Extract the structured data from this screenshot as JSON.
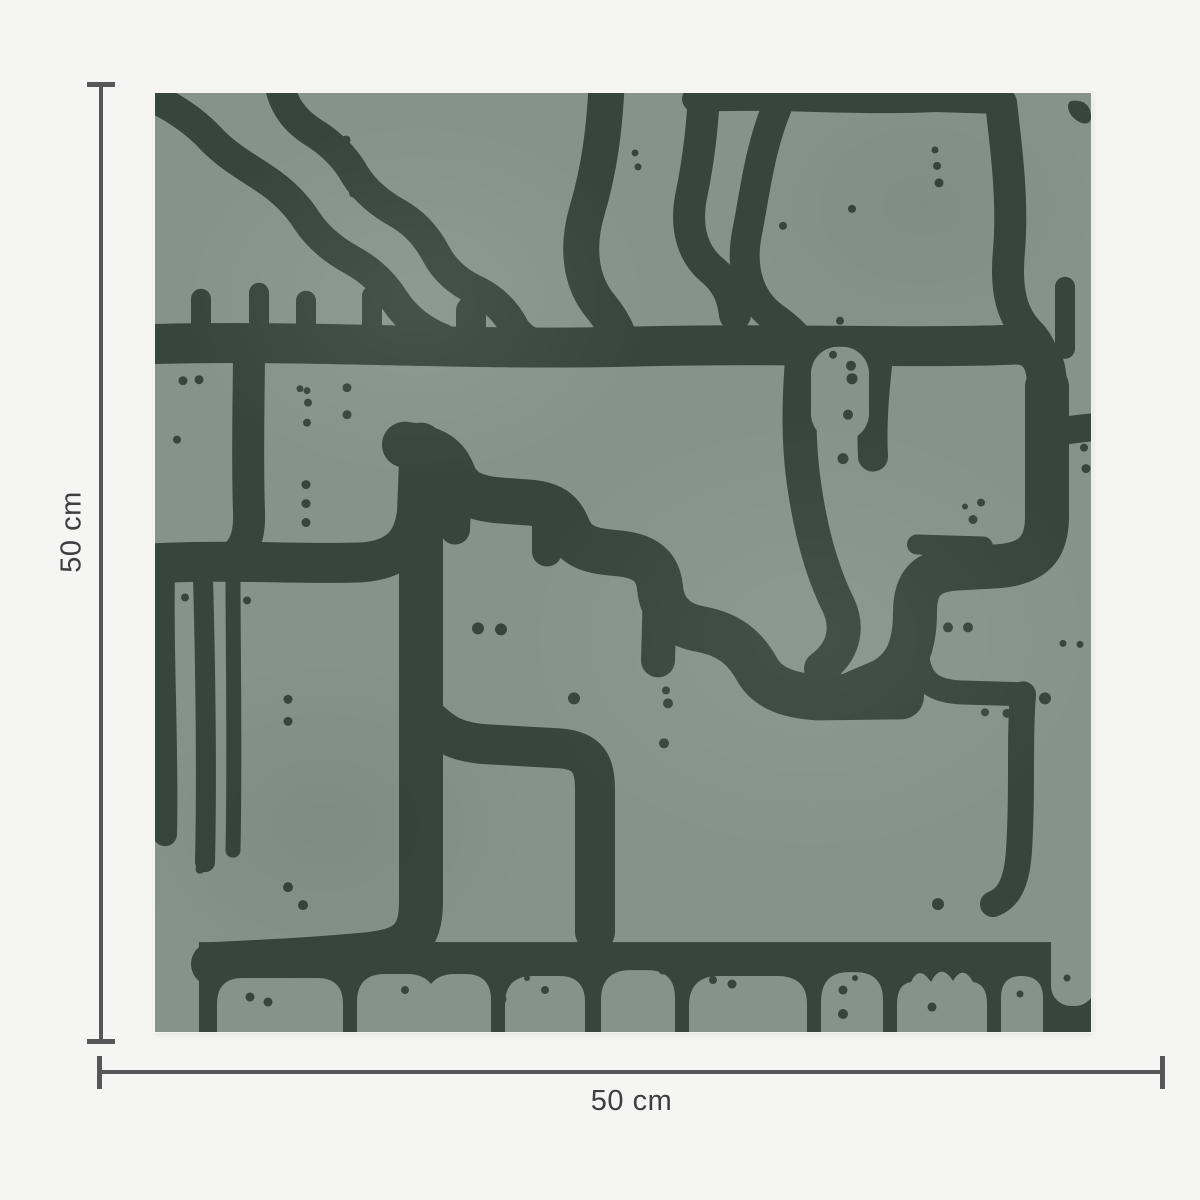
{
  "page": {
    "background_color": "#F5F5F3"
  },
  "product_swatch": {
    "description": "Square wallpaper swatch with abstract organic blob pattern and scattered dots",
    "pattern_colors": {
      "sage_green": "#85938C",
      "dark_green": "#36463E"
    }
  },
  "dimension_annotations": {
    "height": {
      "label": "50 cm"
    },
    "width": {
      "label": "50 cm"
    },
    "line_color": "#57575A",
    "label_color": "#3E3E41"
  }
}
